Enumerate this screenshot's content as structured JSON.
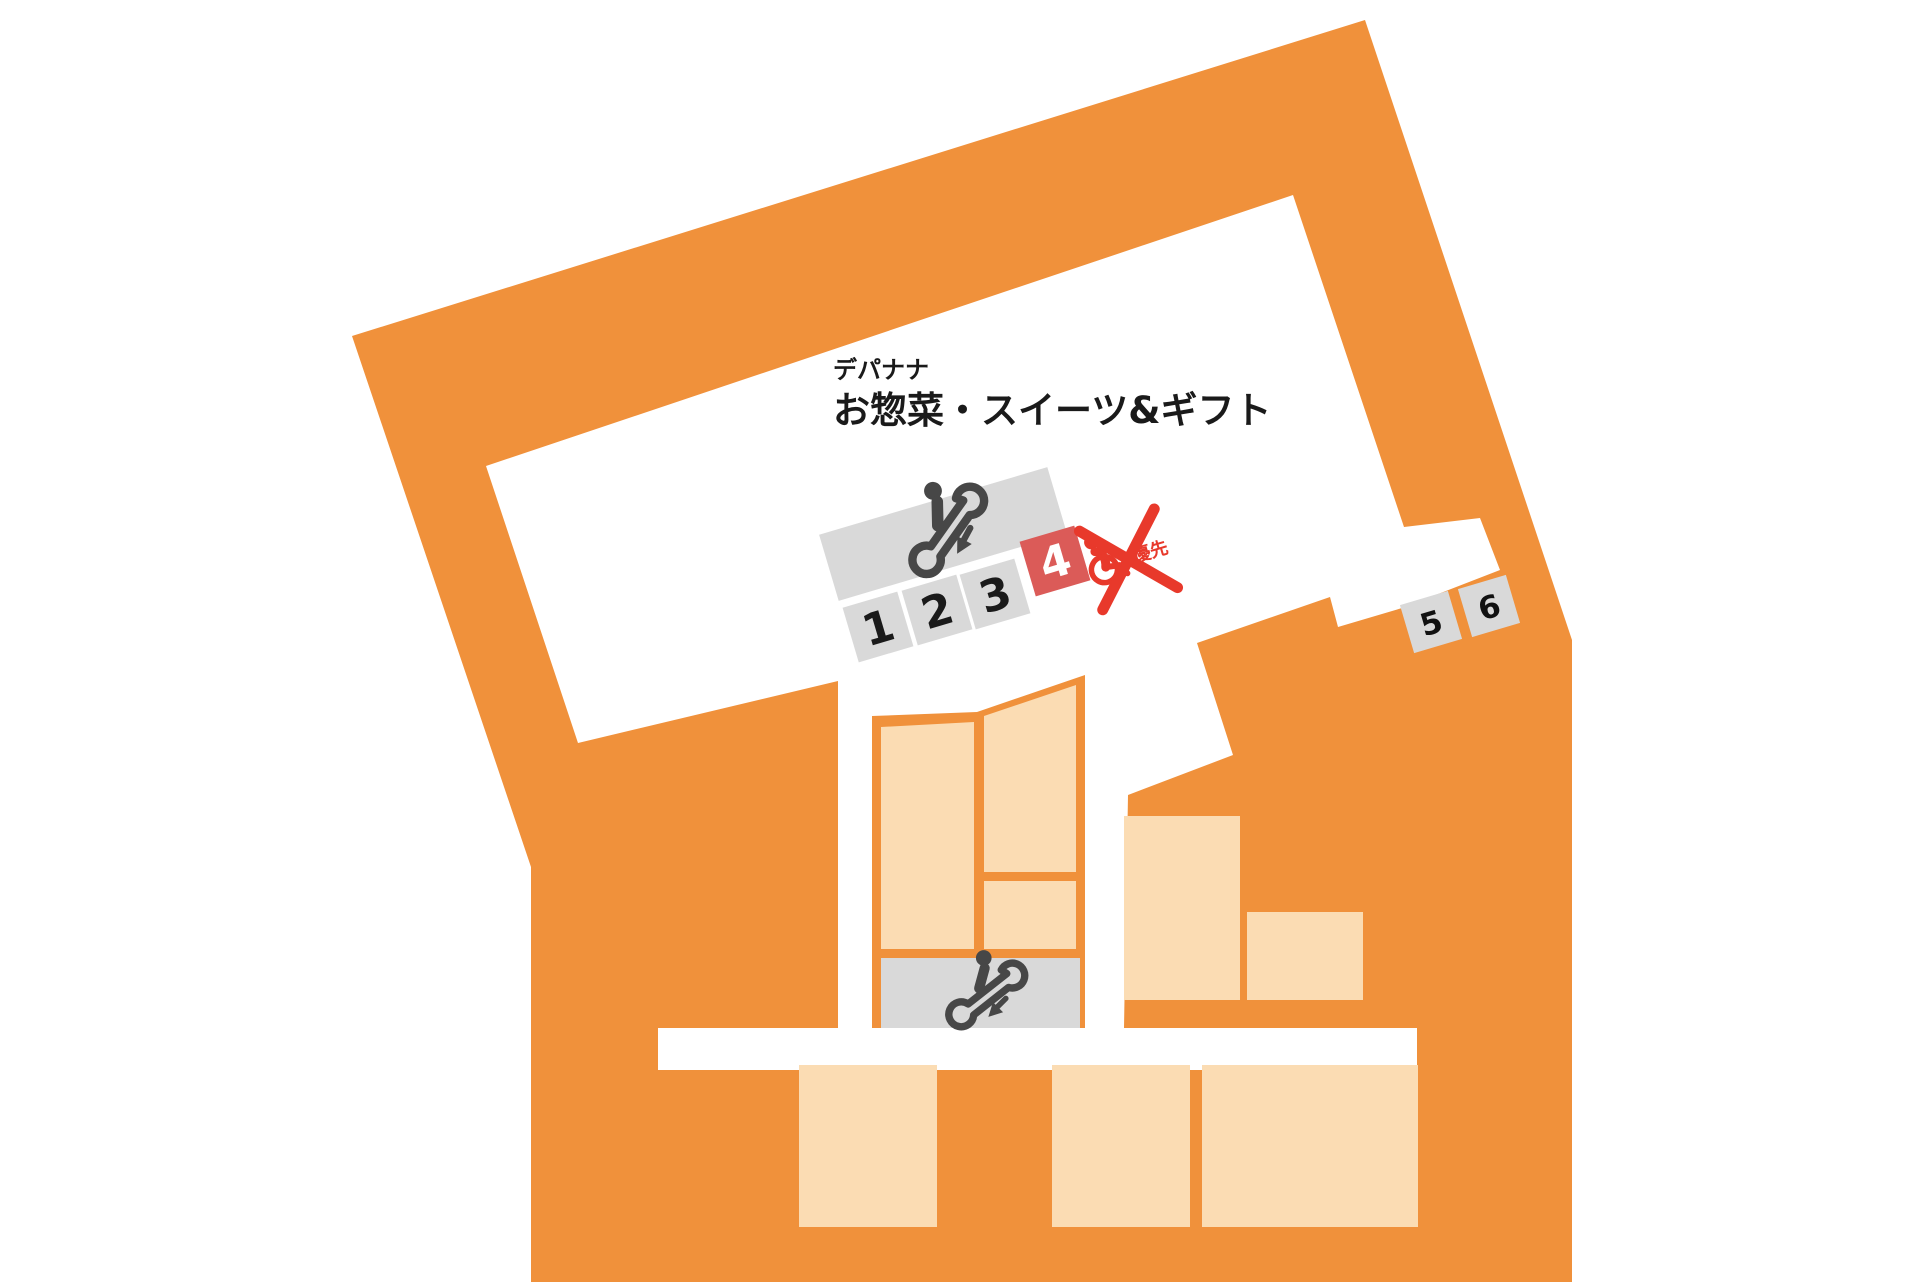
{
  "map": {
    "store_name": "デパナナ",
    "floor_title": "お惣菜・スイーツ&ギフト",
    "counters": [
      {
        "label": "1",
        "highlighted": false
      },
      {
        "label": "2",
        "highlighted": false
      },
      {
        "label": "3",
        "highlighted": false
      },
      {
        "label": "4",
        "highlighted": true
      },
      {
        "label": "5",
        "highlighted": false
      },
      {
        "label": "6",
        "highlighted": false
      }
    ],
    "priority_label": "優先",
    "priority_crossed_out": true,
    "icons": {
      "escalator_upper": "escalator-down-icon",
      "escalator_lower": "escalator-down-icon",
      "priority": "wheelchair-priority-icon",
      "cross": "cross-out-x-icon"
    },
    "colors": {
      "orange": "#F0913B",
      "peach": "#FBDCB3",
      "gray_box": "#D9D9D9",
      "highlight_red": "#DB5B58",
      "cross_red": "#E8392B",
      "icon_dark": "#474747",
      "text_dark": "#1a1a1a",
      "white": "#ffffff"
    }
  }
}
